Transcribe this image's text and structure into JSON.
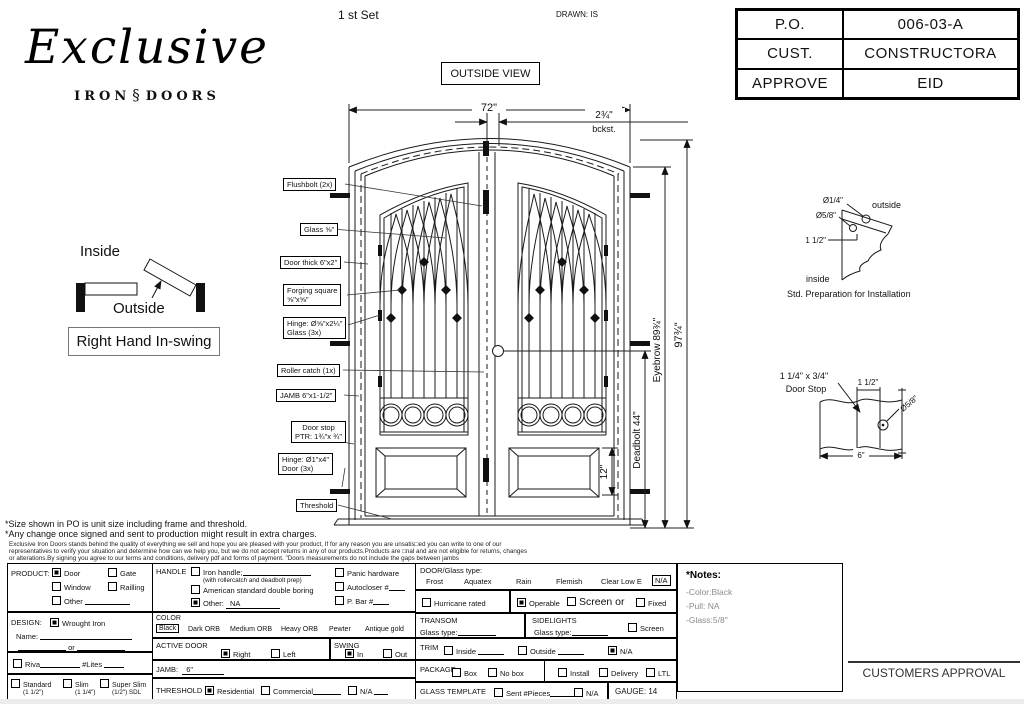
{
  "header": {
    "set_label": "1 st Set",
    "drawn_label": "DRAWN: IS",
    "po_table": {
      "rows": [
        {
          "label": "P.O.",
          "value": "006-03-A"
        },
        {
          "label": "CUST.",
          "value": "CONSTRUCTORA"
        },
        {
          "label": "APPROVE",
          "value": "EID"
        }
      ]
    }
  },
  "logo": {
    "name": "Exclusive",
    "word_iron": "IRON",
    "word_doors": "DOORS",
    "scroll_glyph": "§"
  },
  "drawing": {
    "view_label": "OUTSIDE VIEW",
    "dims": {
      "width": "72\"",
      "backset": "2¾\"",
      "backset_sub": "bckst.",
      "height": "97¾\"",
      "eyebrow": "Eyebrow 89¾\"",
      "deadbolt": "Deadbolt 44\"",
      "panel": "12\""
    },
    "callouts": {
      "flushbolt": "Flushbolt (2x)",
      "glass": "Glass ⅝\"",
      "door_thick": "Door thick 6\"x2\"",
      "forging1": "Forging square",
      "forging2": "⅝\"x⅝\"",
      "hinge_glass1": "Hinge: Ø⅝\"x2¼\"",
      "hinge_glass2": "Glass (3x)",
      "roller": "Roller catch  (1x)",
      "jamb": "JAMB  6\"x1-1/2\"",
      "doorstop1": "Door stop",
      "doorstop2": "PTR: 1¾\"x ¾\"",
      "hinge_door1": "Hinge: Ø1\"x4\"",
      "hinge_door2": "Door (3x)",
      "threshold": "Threshold"
    }
  },
  "swing": {
    "inside": "Inside",
    "outside": "Outside",
    "label": "Right Hand In-swing"
  },
  "install_detail": {
    "d1": "Ø1/4\"",
    "d2": "Ø5/8\"",
    "d3": "1 1/2\"",
    "outside": "outside",
    "inside": "inside",
    "caption": "Std. Preparation for Installation"
  },
  "doorstop_detail": {
    "size1": "1 1/4\" x 3/4\"",
    "size2": "Door Stop",
    "d1": "1 1/2\"",
    "d2": "Ø5/8\"",
    "d3": "6\""
  },
  "footnotes": {
    "line1": "*Size shown in PO is unit size including frame and threshold.",
    "line2": "*Any change once signed and sent to production might result in extra charges.",
    "small1": "Exclusive Iron Doors stands behind the quality of everything we sell and hope you are pleased with your product, If for any reason you are unsatis□ed you can write to one of our",
    "small2": "representatives to verify your situation and determine how can we help you, but we do not accept returns in any of our products.Products are □nal and are not eligible for returns, changes",
    "small3": "or alterations.By signing you agree to our terms and conditions, delivery pdf and forms of payment. \"Doors measurements do not include the gaps between jambs"
  },
  "form": {
    "product": {
      "title": "PRODUCT:",
      "opt_door": "Door",
      "opt_gate": "Gate",
      "opt_window": "Window",
      "opt_railing": "Railling",
      "opt_other": "Other"
    },
    "handle": {
      "title": "HANDLE",
      "iron": "Iron handle;",
      "iron_sub": "(with rollercatch and deadbolt prep)",
      "american": "American standard double boring",
      "other": "Other:",
      "other_value": "NA",
      "panic": "Panic hardware",
      "autocloser": "Autocloser #",
      "pbar": "P. Bar #"
    },
    "design": {
      "title": "DESIGN:",
      "wrought": "Wrought Iron",
      "name_label": "Name:",
      "or": "or"
    },
    "riva": {
      "label": "Riva",
      "lites": "#Lites"
    },
    "thickness": {
      "standard": "Standard",
      "standard_sub": "(1 1/2\")",
      "slim": "Slim",
      "slim_sub": "(1 1/4\")",
      "superslim": "Super Slim",
      "superslim_sub": "(1/2\") SDL"
    },
    "color": {
      "title": "COLOR",
      "options": [
        "Black",
        "Dark ORB",
        "Medium ORB",
        "Heavy ORB",
        "Pewter",
        "Antique gold"
      ]
    },
    "active_door": {
      "title": "ACTIVE DOOR",
      "right": "Right",
      "left": "Left"
    },
    "swing": {
      "title": "SWING",
      "in": "In",
      "out": "Out"
    },
    "jamb": {
      "title": "JAMB:",
      "value": "6\""
    },
    "threshold": {
      "title": "THRESHOLD",
      "residential": "Residential",
      "commercial": "Commercial",
      "na": "N/A"
    },
    "door_glass": {
      "title": "DOOR/Glass type:",
      "options": [
        "Frost",
        "Aquatex",
        "Rain",
        "Flemish",
        "Clear Low E",
        "N/A"
      ]
    },
    "hurricane": "Hurricane rated",
    "operable": {
      "operable": "Operable",
      "screen_or": "Screen or",
      "fixed": "Fixed"
    },
    "transom": {
      "title": "TRANSOM",
      "glass_type": "Glass type:"
    },
    "sidelights": {
      "title": "SIDELIGHTS",
      "glass_type": "Glass type:",
      "screen": "Screen"
    },
    "trim": {
      "title": "TRIM",
      "inside": "Inside",
      "outside": "Outside",
      "na": "N/A"
    },
    "package": {
      "title": "PACKAGE",
      "box": "Box",
      "nobox": "No box",
      "install": "Install",
      "delivery": "Delivery",
      "ltl": "LTL"
    },
    "glass_template": {
      "title": "GLASS TEMPLATE",
      "sent": "Sent #Pieces",
      "na": "N/A"
    },
    "gauge": "GAUGE: 14"
  },
  "notes": {
    "title": "*Notes:",
    "items": [
      "-Color:Black",
      "-Pull: NA",
      "-Glass:5/8\""
    ]
  },
  "approval": "CUSTOMERS APPROVAL"
}
